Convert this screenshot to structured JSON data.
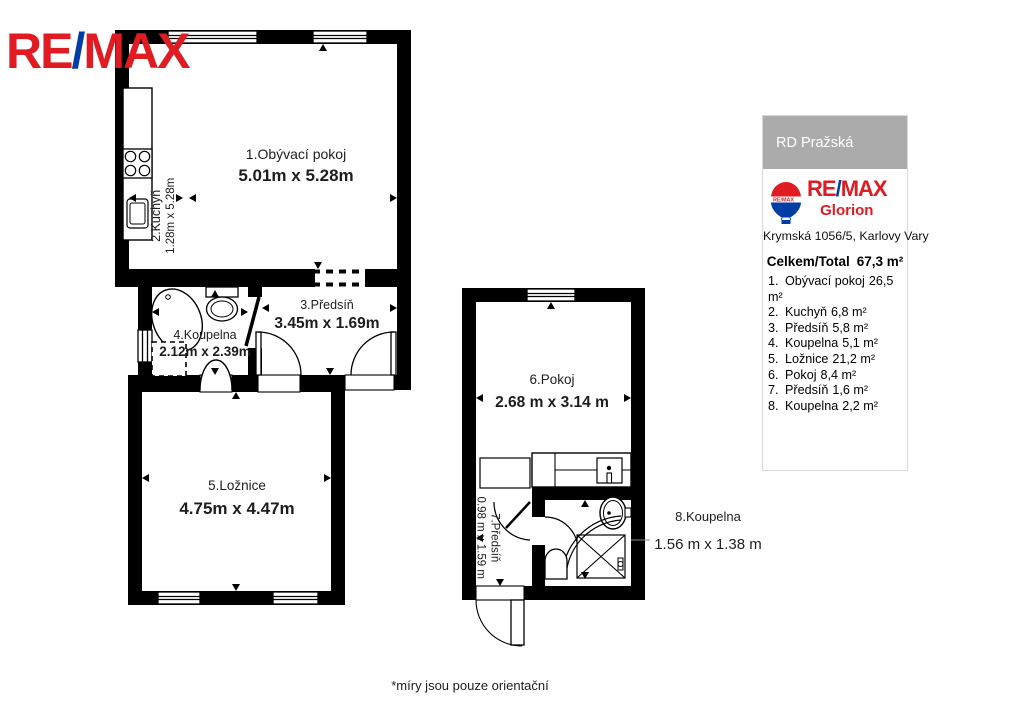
{
  "logo": {
    "re": "RE",
    "slash": "/",
    "max": "MAX"
  },
  "plan": {
    "rooms": [
      {
        "label": "1.Obývací pokoj",
        "dims": "5.01m x 5.28m"
      },
      {
        "label": "2.Kuchyň",
        "dims": "1.28m x 5.28m"
      },
      {
        "label": "3.Předsíň",
        "dims": "3.45m x 1.69m"
      },
      {
        "label": "4.Koupelna",
        "dims": "2.12m x 2.39m"
      },
      {
        "label": "5.Ložnice",
        "dims": "4.75m x 4.47m"
      },
      {
        "label": "6.Pokoj",
        "dims": "2.68 m x 3.14 m"
      },
      {
        "label": "7.Předsíň",
        "dims": "0.98 m x 1.59 m"
      },
      {
        "label": "8.Koupelna",
        "dims": "1.56 m x 1.38 m"
      }
    ],
    "footnote": "*míry jsou pouze orientační"
  },
  "panel": {
    "header": "RD Pražská",
    "brand": {
      "re": "RE",
      "slash": "/",
      "max": "MAX",
      "office": "Glorion",
      "balloon_text": "RE/MAX"
    },
    "address": "Krymská 1056/5, Karlovy Vary",
    "total_label": "Celkem/Total",
    "total_value": "67,3 m²",
    "items": [
      {
        "num": "1.",
        "name": "Obývací pokoj",
        "area": "26,5 m²"
      },
      {
        "num": "2.",
        "name": "Kuchyň",
        "area": "6,8 m²"
      },
      {
        "num": "3.",
        "name": "Předsíň",
        "area": "5,8 m²"
      },
      {
        "num": "4.",
        "name": "Koupelna",
        "area": "5,1 m²"
      },
      {
        "num": "5.",
        "name": "Ložnice",
        "area": "21,2 m²"
      },
      {
        "num": "6.",
        "name": "Pokoj",
        "area": "8,4 m²"
      },
      {
        "num": "7.",
        "name": "Předsíň",
        "area": "1,6 m²"
      },
      {
        "num": "8.",
        "name": "Koupelna",
        "area": "2,2 m²"
      }
    ]
  },
  "colors": {
    "remax_red": "#E11B22",
    "remax_blue": "#003DA5",
    "panel_header_gray": "#ABABAB",
    "wall_black": "#000000"
  }
}
